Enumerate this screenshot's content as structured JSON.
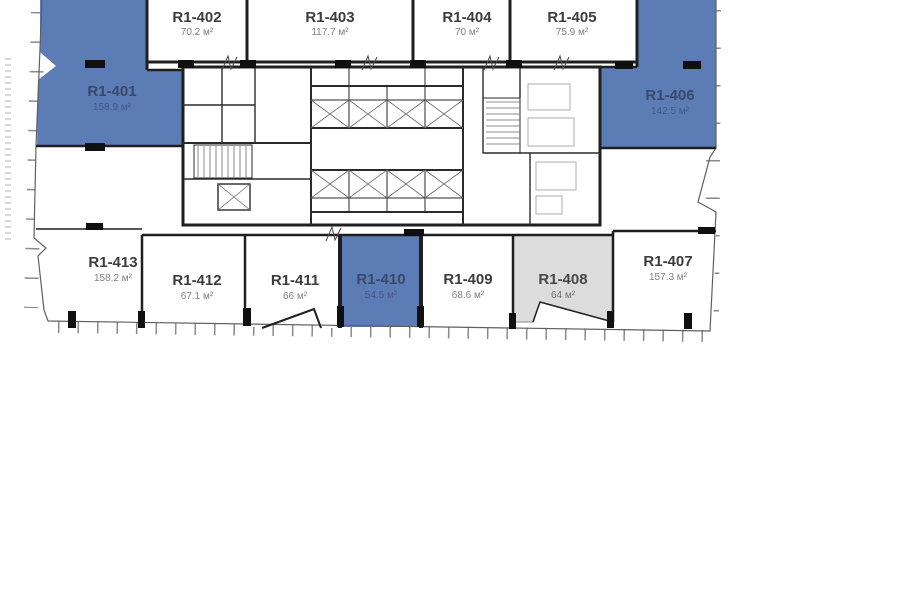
{
  "colors": {
    "unit_highlight_blue": "#5b7cb4",
    "unit_reserved_gray": "#dcdcdc",
    "wall_dark": "#1f1f1f",
    "background": "#ffffff"
  },
  "units": [
    {
      "id": "R1-401",
      "area": "158.9 м²",
      "variant": "blue"
    },
    {
      "id": "R1-402",
      "area": "70.2 м²",
      "variant": "white"
    },
    {
      "id": "R1-403",
      "area": "117.7 м²",
      "variant": "white"
    },
    {
      "id": "R1-404",
      "area": "70 м²",
      "variant": "white"
    },
    {
      "id": "R1-405",
      "area": "75.9 м²",
      "variant": "white"
    },
    {
      "id": "R1-406",
      "area": "142.5 м²",
      "variant": "blue"
    },
    {
      "id": "R1-407",
      "area": "157.3 м²",
      "variant": "white"
    },
    {
      "id": "R1-408",
      "area": "64 м²",
      "variant": "gray"
    },
    {
      "id": "R1-409",
      "area": "68.6 м²",
      "variant": "white"
    },
    {
      "id": "R1-410",
      "area": "54.5 м²",
      "variant": "blue"
    },
    {
      "id": "R1-411",
      "area": "66 м²",
      "variant": "white"
    },
    {
      "id": "R1-412",
      "area": "67.1 м²",
      "variant": "white"
    },
    {
      "id": "R1-413",
      "area": "158.2 м²",
      "variant": "white"
    }
  ]
}
